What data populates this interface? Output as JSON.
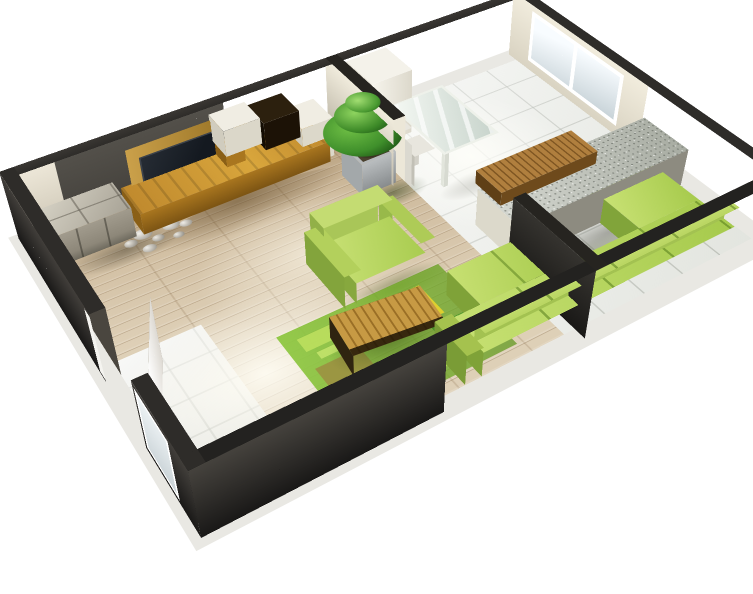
{
  "scene": "3d-apartment-floor-plan-render",
  "visible_text": [],
  "colors": {
    "wall-top": "#2e2c29",
    "wall-outer": "#3b3834",
    "wall-outer-dark": "#191817",
    "wall-inner": "#ece6d7",
    "wall-inner-shade": "#c9c2b1",
    "wall-dark-patch": "#413e39",
    "wall-inner-near": "#23211f",
    "floor-wood": "#d5c5ab",
    "tile": "#eceee9",
    "oak": "#c08a2e",
    "oak-face": "#a9761f",
    "oak-dark": "#8a5f16",
    "tv": "#141920",
    "white-box": "#f0ede3",
    "stone-top": "#d8d4c7",
    "stone-face": "#8d8779",
    "pebble": "#dbd8cf",
    "sofa-top": "#c6e072",
    "sofa-top2": "#a6ca4c",
    "sofa-north": "#95b945",
    "sofa-west": "#7fa238",
    "rug": "#80bf33",
    "rug-yellow": "#e6d22c",
    "rug-olive": "#9c9140",
    "table-wood": "#b9883c",
    "table-wood-dark": "#8a6220",
    "counter-top": "#c1c5bb",
    "counter-face": "#edeadb",
    "glass": "#eaf0ea",
    "frame": "#ffffff",
    "window-glass": "#dde8ed",
    "plant": "#3f8f2b",
    "plant-dark": "#1d5414",
    "planter": "#a3a8aa",
    "door": "#f5f4f0",
    "cabinet-top": "#4a3415",
    "cabinet-face": "#241705",
    "soil": "#30261a"
  },
  "rooms": [
    {
      "name": "living-room",
      "floor": "light-wood-planks"
    },
    {
      "name": "hallway",
      "floor": "light-tiles"
    },
    {
      "name": "kitchen",
      "floor": "white-tiles"
    }
  ],
  "furniture": [
    "tv-wall-unit",
    "television",
    "stone-sideboard",
    "decorative-pebbles",
    "potted-plant",
    "green-armchair",
    "green-area-rug",
    "wooden-coffee-table",
    "green-corner-sofa",
    "dark-wood-cabinet",
    "kitchen-counter",
    "wooden-bar-top",
    "glass-dining-table",
    "dining-chair",
    "dining-chair",
    "tall-white-cabinet",
    "wall-mirror",
    "entry-door",
    "kitchen-window",
    "living-room-window"
  ]
}
